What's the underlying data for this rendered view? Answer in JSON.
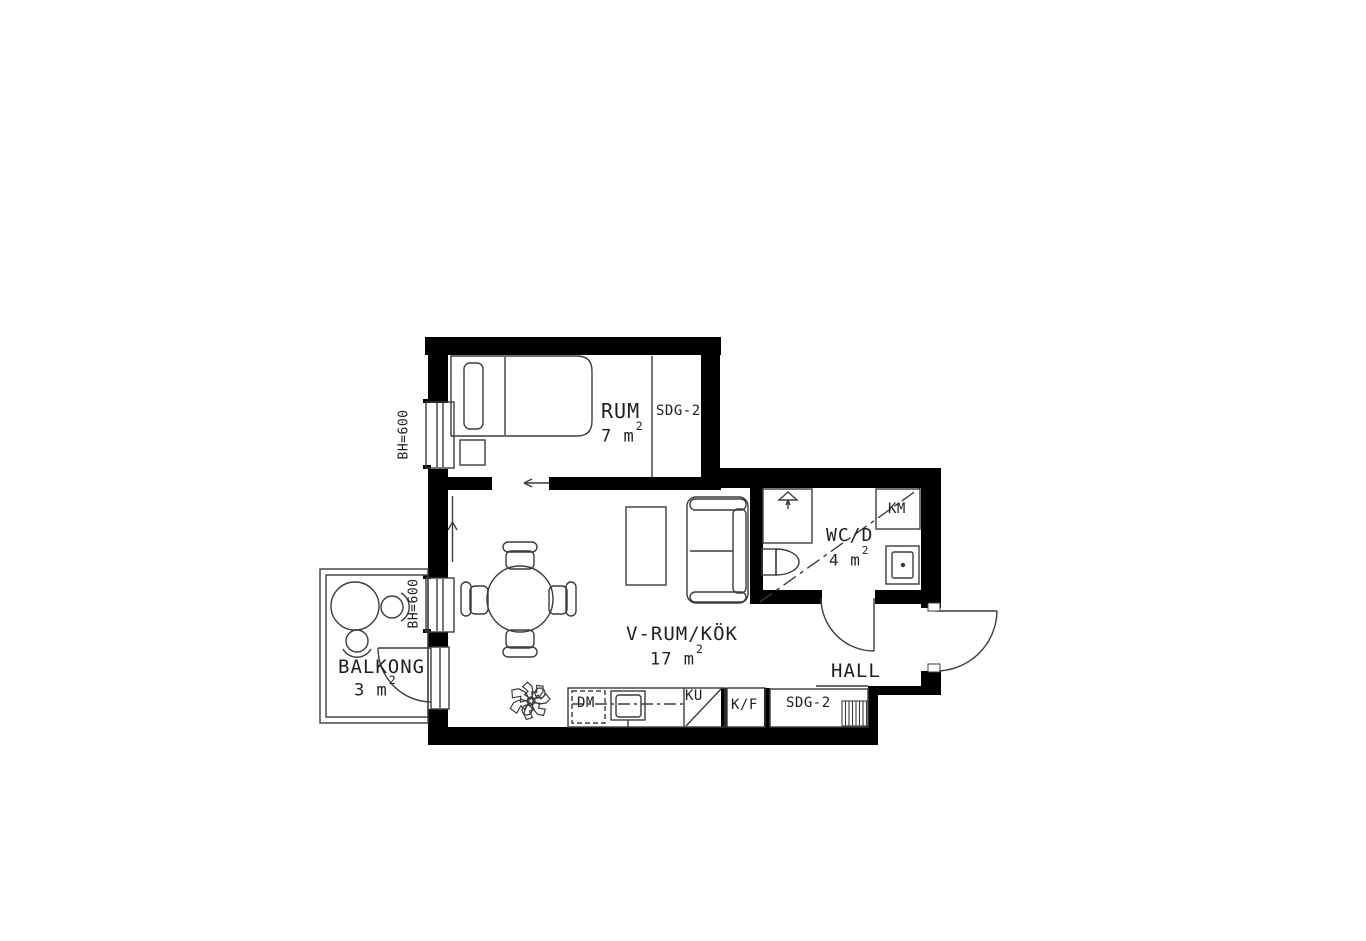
{
  "floorplan": {
    "rooms": {
      "rum": {
        "label": "RUM",
        "area": "7 m",
        "area_sup": "2"
      },
      "vrumkok": {
        "label": "V-RUM/KÖK",
        "area": "17 m",
        "area_sup": "2"
      },
      "wcd": {
        "label": "WC/D",
        "area": "4 m",
        "area_sup": "2"
      },
      "hall": {
        "label": "HALL"
      },
      "balkong": {
        "label": "BALKONG",
        "area": "3 m",
        "area_sup": "2"
      }
    },
    "fixtures": {
      "wardrobe_rum": "SDG-2",
      "wardrobe_hall": "SDG-2",
      "washing_machine": "KM",
      "dishwasher": "DM",
      "cooktop": "KU",
      "fridge_freezer": "K/F"
    },
    "annotations": {
      "window_sill_height_rum": "BH=600",
      "window_sill_height_balkong": "BH=600"
    },
    "colors": {
      "wall": "#000000",
      "line": "#3c3c3c",
      "text": "#1f1f1f",
      "background": "#ffffff"
    }
  }
}
